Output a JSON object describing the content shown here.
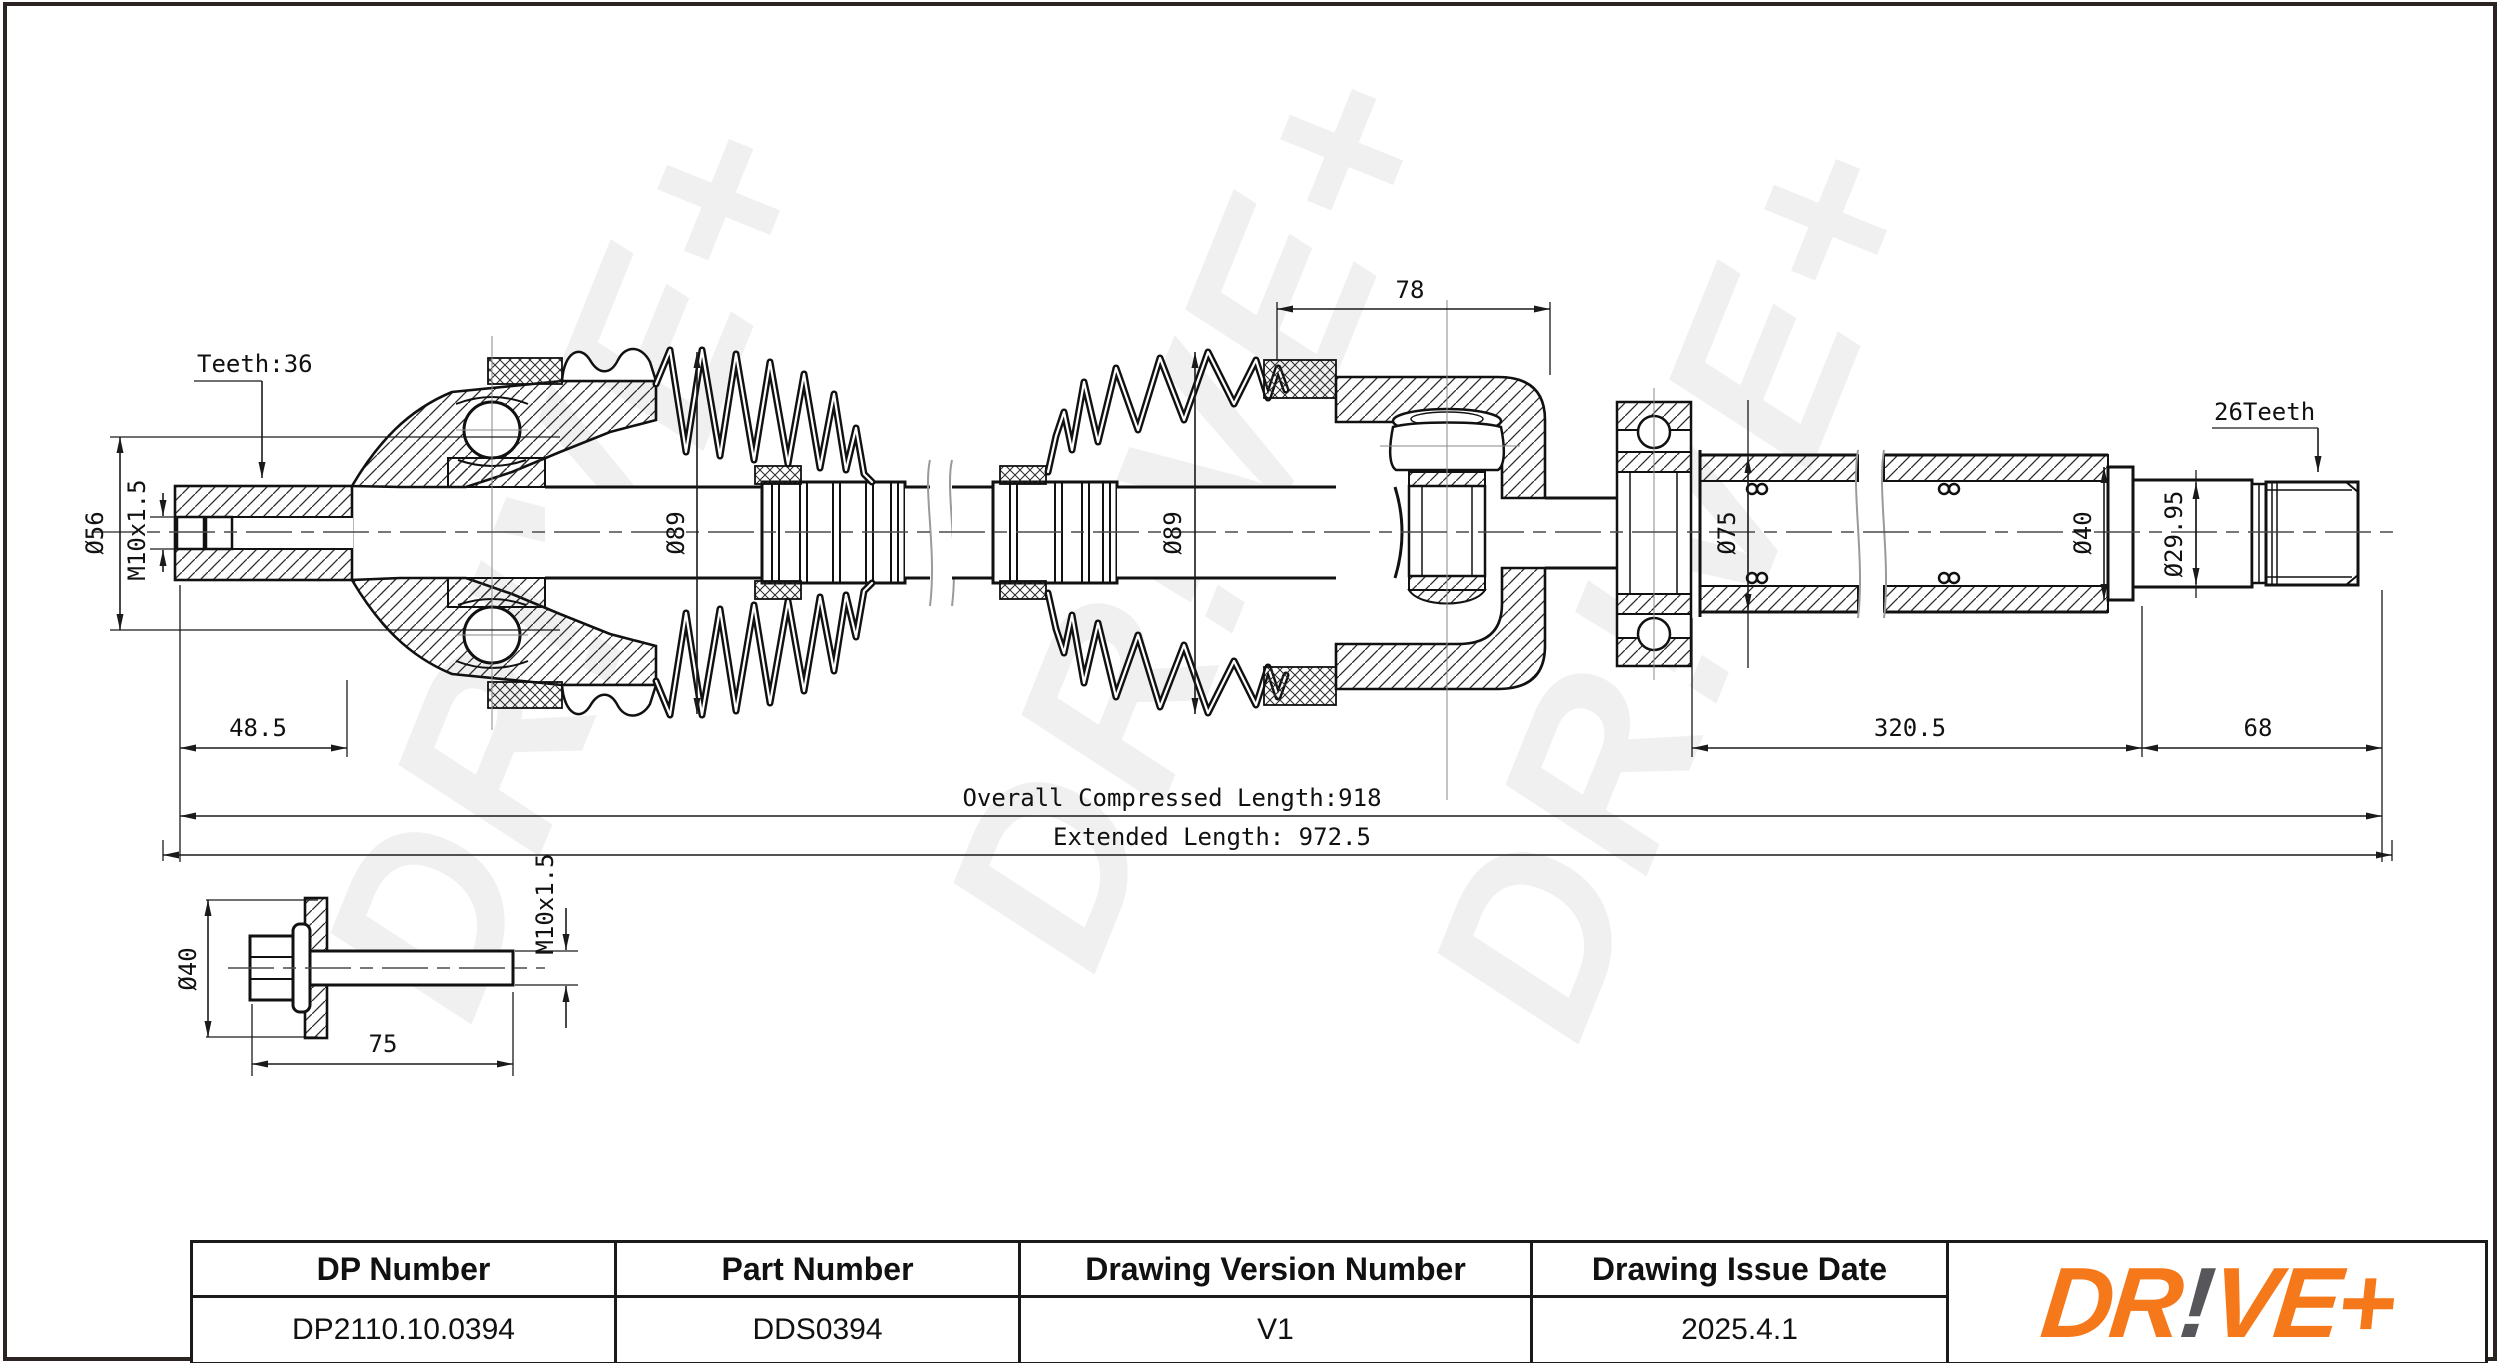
{
  "drawing": {
    "watermark_text": "DR!VE+",
    "labels": {
      "teeth_left": "Teeth:36",
      "dia56": "Ø56",
      "m10": "M10x1.5",
      "dia89_left": "Ø89",
      "dim_78": "78",
      "dia89_right": "Ø89",
      "dia75": "Ø75",
      "dia40": "Ø40",
      "dia29_95": "Ø29.95",
      "teeth_right": "26Teeth",
      "dim_48_5": "48.5",
      "dim_320_5": "320.5",
      "dim_68": "68",
      "overall_compressed_length": "Overall  Compressed  Length:918",
      "extended_length": "Extended  Length: 972.5",
      "bolt_dia40": "Ø40",
      "bolt_m10": "M10x1.5",
      "bolt_length_75": "75"
    }
  },
  "title_block": {
    "columns": [
      {
        "header": "DP Number",
        "value": "DP2110.10.0394"
      },
      {
        "header": "Part Number",
        "value": "DDS0394"
      },
      {
        "header": "Drawing Version Number",
        "value": "V1"
      },
      {
        "header": "Drawing Issue Date",
        "value": "2025.4.1"
      }
    ],
    "logo": {
      "seg1": "DR",
      "seg2": "!",
      "seg3": "VE+",
      "orange": "#F5791B",
      "gray": "#57575B"
    }
  }
}
